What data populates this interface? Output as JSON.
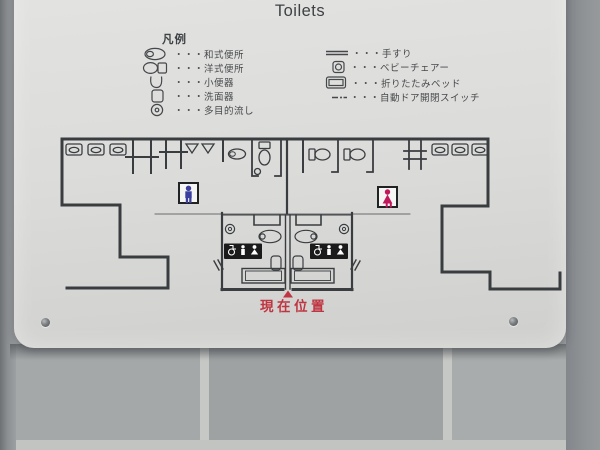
{
  "sign": {
    "title": "Toilets",
    "legend": {
      "heading": "凡例",
      "left": [
        {
          "icon": "squat-toilet-icon",
          "label": "・・・和式便所"
        },
        {
          "icon": "western-toilet-icon",
          "label": "・・・洋式便所"
        },
        {
          "icon": "urinal-icon",
          "label": "・・・小便器"
        },
        {
          "icon": "washbasin-icon",
          "label": "・・・洗面器"
        },
        {
          "icon": "multipurpose-sink-icon",
          "label": "・・・多目的流し"
        }
      ],
      "right": [
        {
          "icon": "handrail-icon",
          "label": "・・・手すり"
        },
        {
          "icon": "baby-chair-icon",
          "label": "・・・ベビーチェアー"
        },
        {
          "icon": "folding-bed-icon",
          "label": "・・・折りたたみベッド"
        },
        {
          "icon": "auto-door-switch-icon",
          "label": "・・・自動ドア開閉スイッチ"
        }
      ]
    },
    "plan": {
      "current_location": "現在位置",
      "male_room_symbol": "male-figure",
      "female_room_symbol": "female-figure",
      "accessible_room_symbols": [
        "wheelchair",
        "adult-with-child",
        "baby-change"
      ]
    },
    "colors": {
      "male_icon": "#3b3f9e",
      "female_icon": "#c2185b",
      "current_location_red": "#bf3642",
      "plan_lines": "#3a3d40",
      "sign_background": "#dcdcda",
      "wall_tile": "#a0a4a6"
    }
  }
}
